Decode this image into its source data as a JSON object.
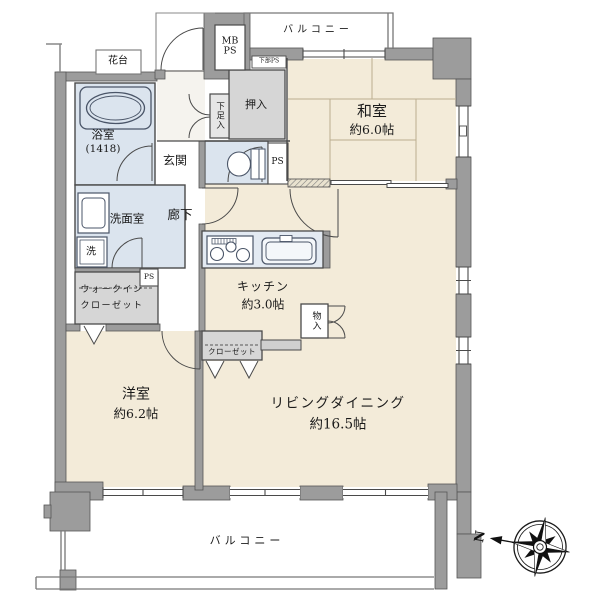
{
  "colors": {
    "wall": "#9c9c9c",
    "floor_beige": "#f3ebd9",
    "wet_blue": "#dbe4ee",
    "closet_gray": "#d6d6d6",
    "line": "#4a4a4a"
  },
  "rooms": {
    "washitsu": {
      "name": "和室",
      "size": "約6.0帖"
    },
    "living_dining": {
      "name": "リビングダイニング",
      "size": "約16.5帖"
    },
    "youshitsu": {
      "name": "洋室",
      "size": "約6.2帖"
    },
    "kitchen": {
      "name": "キッチン",
      "size": "約3.0帖"
    },
    "bathroom": {
      "name": "浴室",
      "size": "(1418)"
    },
    "washroom": {
      "name": "洗面室"
    },
    "genkan": {
      "name": "玄関"
    },
    "hallway": {
      "name": "廊下"
    },
    "walk_in_closet": {
      "line1": "ウォークイン",
      "line2": "クローゼット"
    },
    "oshiire": {
      "name": "押入"
    },
    "closet": {
      "name": "クローゼット"
    },
    "monoire": {
      "name": "物入"
    },
    "shoe_cabinet": {
      "name": "下足入"
    },
    "laundry": {
      "name": "洗"
    },
    "flower_stand": {
      "name": "花台"
    },
    "balcony_top": {
      "name": "バルコニー"
    },
    "balcony_bottom": {
      "name": "バルコニー"
    }
  },
  "labels": {
    "mb_ps_line1": "MB",
    "mb_ps_line2": "PS",
    "lower_ps": "下部PS",
    "ps_toilet": "PS",
    "ps_washroom": "PS",
    "north": "N"
  }
}
